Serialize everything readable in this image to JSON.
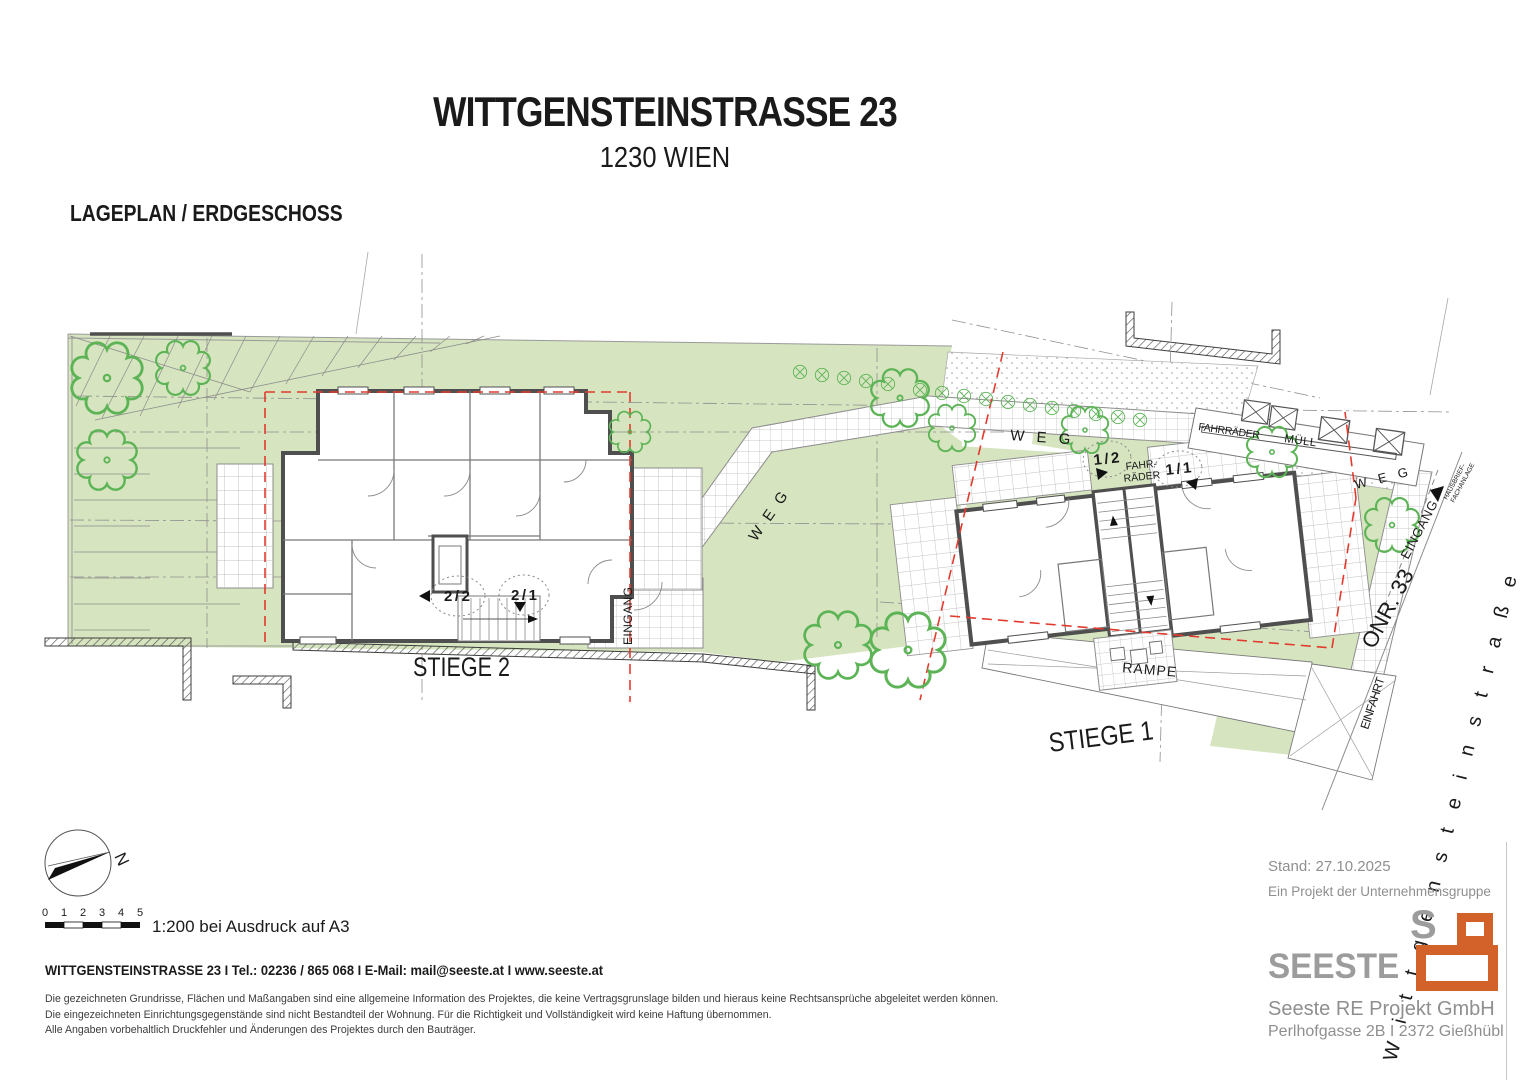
{
  "header": {
    "title": "WITTGENSTEINSTRASSE 23",
    "subtitle": "1230 WIEN",
    "plan_label": "LAGEPLAN / ERDGESCHOSS"
  },
  "plan": {
    "stiege2": "STIEGE 2",
    "stiege1": "STIEGE 1",
    "unit_2_2": "2/2",
    "unit_2_1": "2/1",
    "unit_1_2": "1/2",
    "unit_1_1": "1/1",
    "weg": "W E G",
    "eingang": "EINGANG",
    "einfahrt": "EINFAHRT",
    "rampe": "RAMPE",
    "fahrraeder": "FAHRRÄDER",
    "fahr": "FAHR-",
    "raeder": "RÄDER",
    "muell": "MÜLL",
    "onr": "ONR. 33",
    "strasse": "W i t t g e n s t e i n s t r a ß e",
    "hausbrief_1": "HAUSBRIEF-",
    "hausbrief_2": "FACHANLAGE",
    "north": "N"
  },
  "legend": {
    "scale_ticks": [
      "0",
      "1",
      "2",
      "3",
      "4",
      "5"
    ],
    "scale_note": "1:200 bei Ausdruck auf A3"
  },
  "footer": {
    "contact": "WITTGENSTEINSTRASSE 23 I Tel.: 02236 / 865 068 I E-Mail: mail@seeste.at I www.seeste.at",
    "disclaimer_1": "Die gezeichneten Grundrisse, Flächen und Maßangaben sind eine allgemeine Information des Projektes, die keine Vertragsgrunslage bilden und hieraus keine Rechtsansprüche abgeleitet werden können.",
    "disclaimer_2": "Die eingezeichneten Einrichtungsgegenstände sind nicht Bestandteil der Wohnung. Für die Richtigkeit und Vollständigkeit wird keine Haftung übernommen.",
    "disclaimer_3": "Alle Angaben vorbehaltlich Druckfehler und Änderungen des Projektes durch den Bauträger."
  },
  "brand": {
    "stand": "Stand: 27.10.2025",
    "group": "Ein Projekt der Unternehmensgruppe",
    "logo_word": "SEESTE",
    "logo_s": "S",
    "company": "Seeste RE Projekt GmbH",
    "address": "Perlhofgasse 2B I 2372 Gießhübl",
    "orange": "#d2622a",
    "gray": "#9c9c9c"
  },
  "colors": {
    "site_green": "#d6e4bf",
    "tree_green": "#5db457",
    "boundary_red": "#e23b2e",
    "wall_gray": "#4f4f4f"
  }
}
